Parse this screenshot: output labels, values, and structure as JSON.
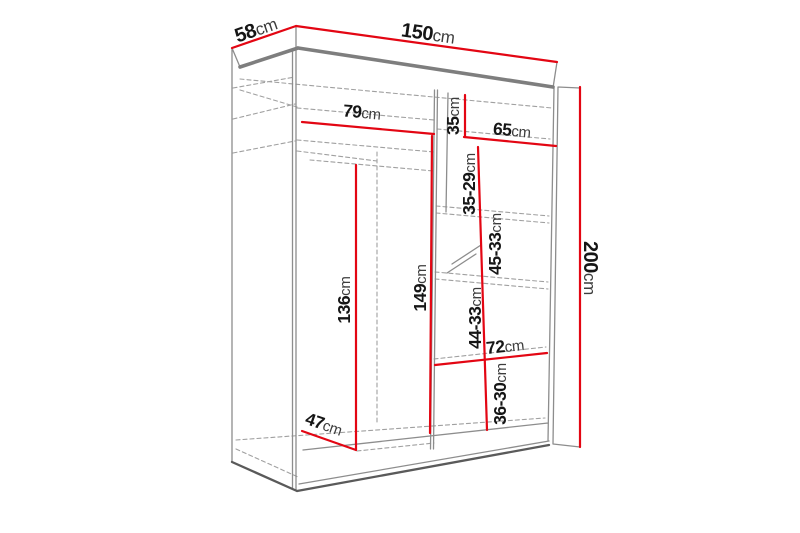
{
  "diagram": {
    "type": "wardrobe-dimension-diagram",
    "unit": "cm",
    "colors": {
      "dimension_line": "#e30613",
      "outline": "#8d8d8d",
      "outline_dark": "#5a5a5a",
      "outline_thick": "#7e7e7e",
      "dashed_line": "#a0a0a0",
      "label_number": "#161616",
      "label_unit": "#3d3d3d",
      "background": "#ffffff"
    },
    "dimensions": {
      "width": {
        "value": "150",
        "unit": "cm"
      },
      "depth": {
        "value": "58",
        "unit": "cm"
      },
      "height": {
        "value": "200",
        "unit": "cm"
      },
      "left_shelf_width": {
        "value": "79",
        "unit": "cm"
      },
      "right_shelf_width": {
        "value": "65",
        "unit": "cm"
      },
      "top_niche_height": {
        "value": "35",
        "unit": "cm"
      },
      "shelf_gap_1": {
        "value": "35-29",
        "unit": "cm"
      },
      "shelf_gap_2": {
        "value": "45-33",
        "unit": "cm"
      },
      "shelf_gap_3": {
        "value": "44-33",
        "unit": "cm"
      },
      "shelf_gap_4": {
        "value": "36-30",
        "unit": "cm"
      },
      "hanging_height": {
        "value": "136",
        "unit": "cm"
      },
      "inner_height": {
        "value": "149",
        "unit": "cm"
      },
      "bottom_shelf_width": {
        "value": "72",
        "unit": "cm"
      },
      "floor_depth": {
        "value": "47",
        "unit": "cm"
      }
    }
  }
}
